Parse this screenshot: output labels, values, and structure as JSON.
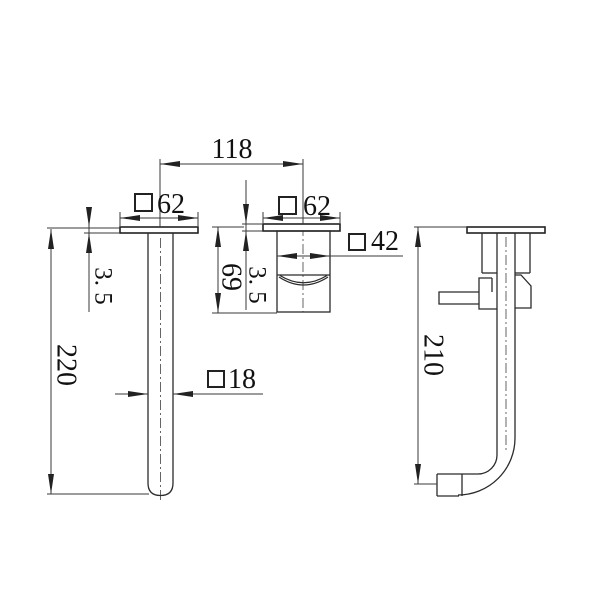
{
  "page": {
    "background": "#ffffff",
    "line_color": "#2b2b2b",
    "description": "technical dimension drawing of wall-mounted spout and mixer valve"
  },
  "dimensions": {
    "center_spacing": "118",
    "spout_flange_width": "62",
    "valve_flange_width": "62",
    "valve_body_width": "42",
    "valve_body_depth": "69",
    "spout_flange_thickness": "3. 5",
    "valve_flange_thickness": "3. 5",
    "spout_drop_length": "220",
    "spout_tube_width": "18",
    "side_overall_height": "210"
  }
}
